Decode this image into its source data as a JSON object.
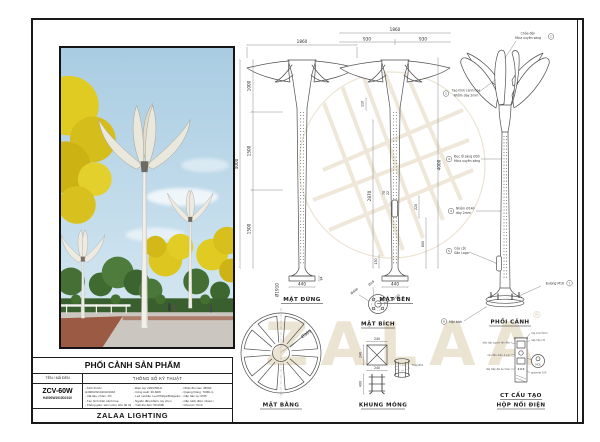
{
  "doc": {
    "watermark_text": "ZALAA",
    "watermark_reg": "®"
  },
  "title_block": {
    "header": "PHỐI CẢNH SẢN PHẨM",
    "name_header": "TÊN / MÃ ĐÈN",
    "model": "ZCV-60W",
    "model_code": "H4000W1910D1910",
    "specs_header": "THÔNG SỐ KỸ THUẬT",
    "brand": "ZALAA LIGHTING",
    "specs_col1": [
      "- Kích thước: H4000xW1910xD1910",
      "- Vật liệu: nhôm, PC",
      "- Tạo hình thân cánh hoa",
      "- Không gian: sân vườn, khu đô thị"
    ],
    "specs_col2": [
      "- Điện áp: 220V/50Hz",
      "- Công suất: 30-60W",
      "- Led module: Led Philips/Bridgelux",
      "- Nguồn điều khiển: tùy chọn",
      "- Tuổi thọ đèn: 50.000h"
    ],
    "specs_col3": [
      "- Nhiệt độ màu: 4500K",
      "- Quang thông: 7000Lm",
      "- Cấp bảo vệ: IP65",
      "- Cấp cách điện: Class I",
      "- Chịu lực: IK10"
    ]
  },
  "views": {
    "front": {
      "label": "MẶT ĐỨNG",
      "dim_top": "1860",
      "dim_h1": "1000",
      "dim_h2": "1500",
      "dim_h3": "1500",
      "dim_total": "4000",
      "dim_base": "440",
      "dim_base_h": "94"
    },
    "side": {
      "label": "MẶT BÊN",
      "dim_top": "1860",
      "dim_top_l": "930",
      "dim_top_r": "930",
      "dim_110": "110",
      "dim_2870": "2870",
      "dim_total": "4000",
      "dim_70": "70",
      "dim_22": "22",
      "dim_220": "220",
      "dim_600": "600",
      "dim_130": "130",
      "dim_base": "440"
    },
    "persp": {
      "label": "PHỐI CẢNH",
      "callouts": {
        "c1": {
          "num": "1",
          "l1": "Chóa đèn",
          "l2": "Mica xuyên sáng"
        },
        "c2": {
          "num": "2",
          "l1": "Tạo hình cánh hoa",
          "l2": "Nhôm dày 2mm"
        },
        "c4": {
          "num": "4",
          "l1": "Đục lỗ sáng Ø30",
          "l2": "Mica xuyên sáng"
        },
        "c3": {
          "num": "3",
          "l1": "Nhôm Ø140",
          "l2": "dày 2mm"
        },
        "c5": {
          "num": "5",
          "l1": "Cửa cột",
          "l2": "Gắn Logo"
        },
        "c7": {
          "num": "7",
          "l1": "Bulong M16"
        },
        "c6": {
          "num": "6",
          "l1": "Mặt bích"
        }
      }
    },
    "plan": {
      "label": "MẶT BẰNG",
      "dim_outer": "Ø1910",
      "dim_inner": "Ø365"
    },
    "flange": {
      "label": "MẶT BÍCH",
      "dim_outer": "Ø440",
      "dim_hole": "Ø18",
      "dim_bc": "Ø142"
    },
    "foundation": {
      "label": "KHUNG MÓNG",
      "dim_w": "240",
      "dim_w2": "240",
      "dim_w3": "240",
      "dim_h": "400",
      "note": "Thép Ø16"
    },
    "junction": {
      "label1": "CT CẤU TẠO",
      "label2": "HỘP NỐI ĐIỆN",
      "detail": "MCB",
      "labels_left": [
        "dây cấp nguồn lên đèn",
        "cầu đấu điện 4 cực",
        "dây tiếp địa an toàn"
      ],
      "labels_right": [
        "cáp 2x2.5mm",
        "nắp hộp nối",
        "aptomat 10A"
      ]
    }
  }
}
